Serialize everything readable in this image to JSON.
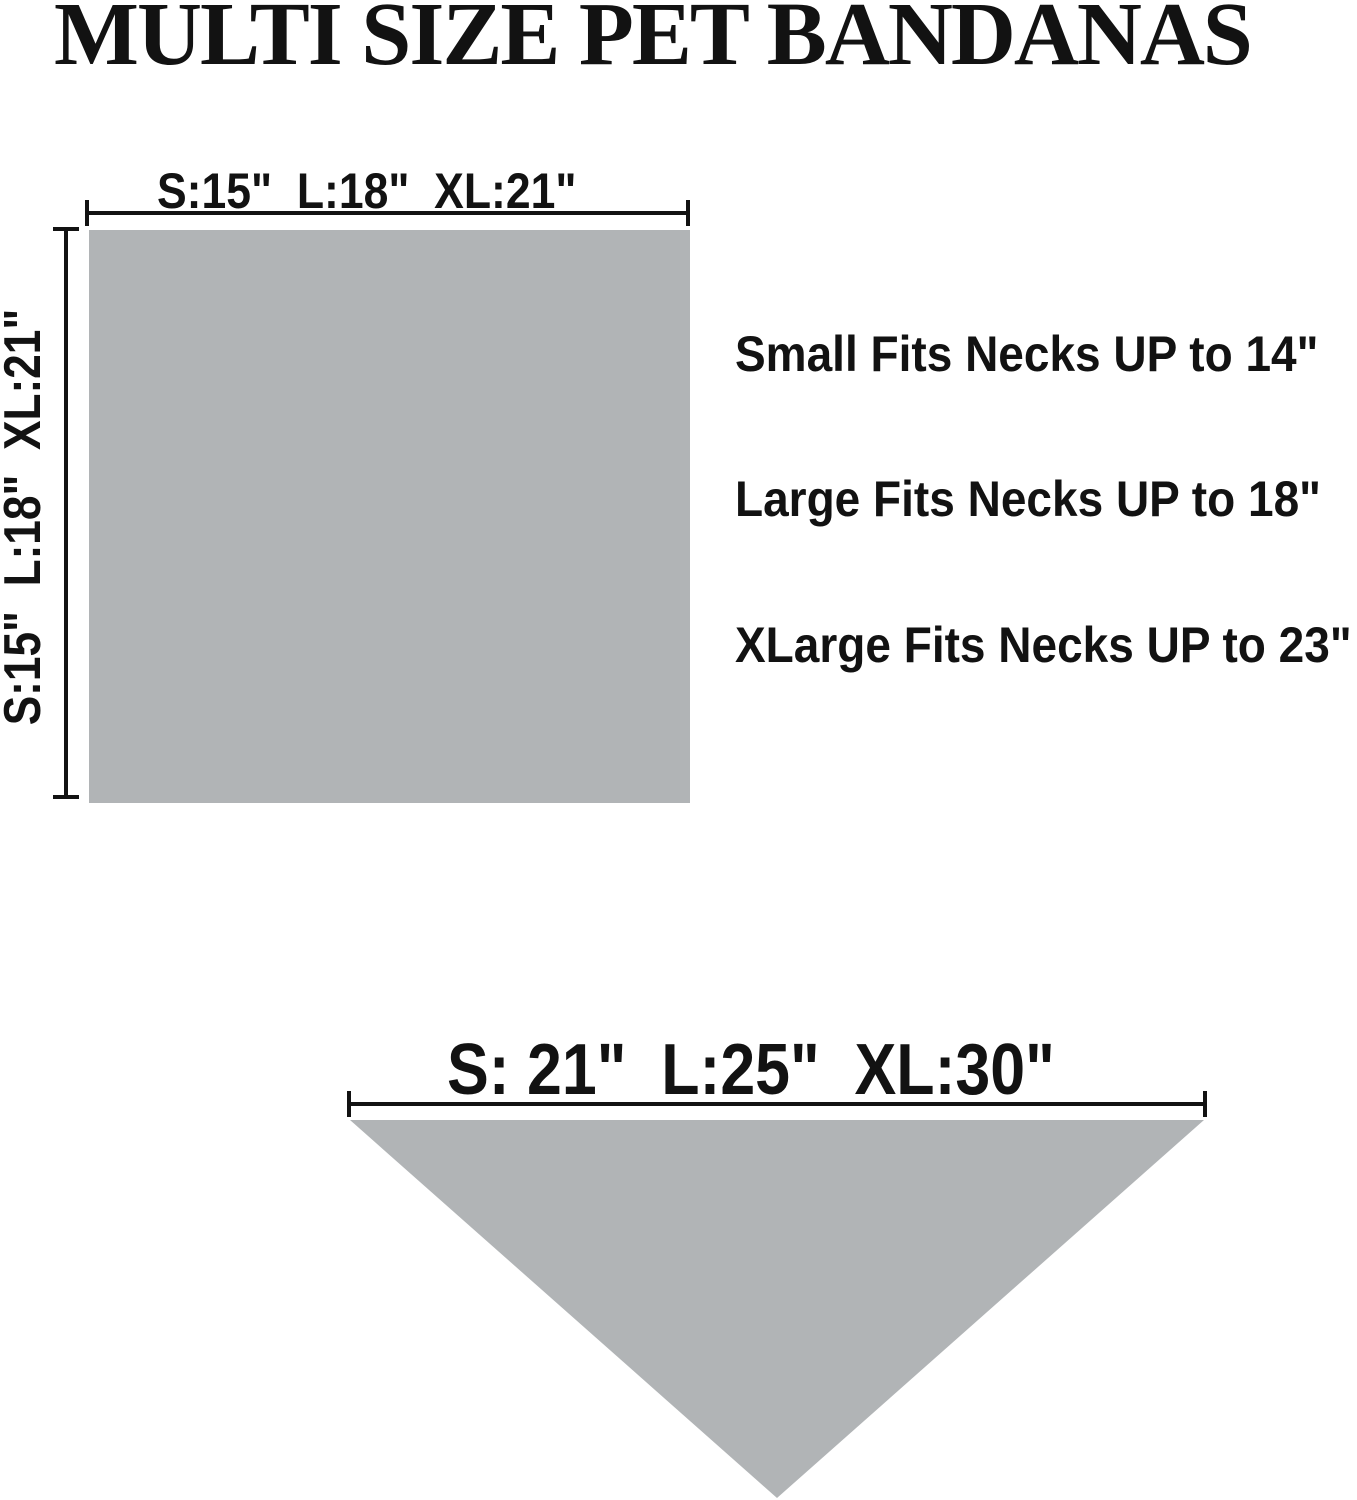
{
  "title": "MULTI SIZE PET BANDANAS",
  "colors": {
    "fabric_gray": "#b1b4b6",
    "ink": "#121212"
  },
  "square_diagram": {
    "width_label": "S:15\"  L:18\"  XL:21\"",
    "height_label": "S:15\"  L:18\"  XL:21\""
  },
  "fit_notes": {
    "small": "Small Fits Necks UP to 14\"",
    "large": "Large Fits Necks UP to 18\"",
    "xlarge": "XLarge Fits Necks UP to 23\""
  },
  "triangle_diagram": {
    "width_label": "S: 21\"  L:25\"  XL:30\""
  }
}
